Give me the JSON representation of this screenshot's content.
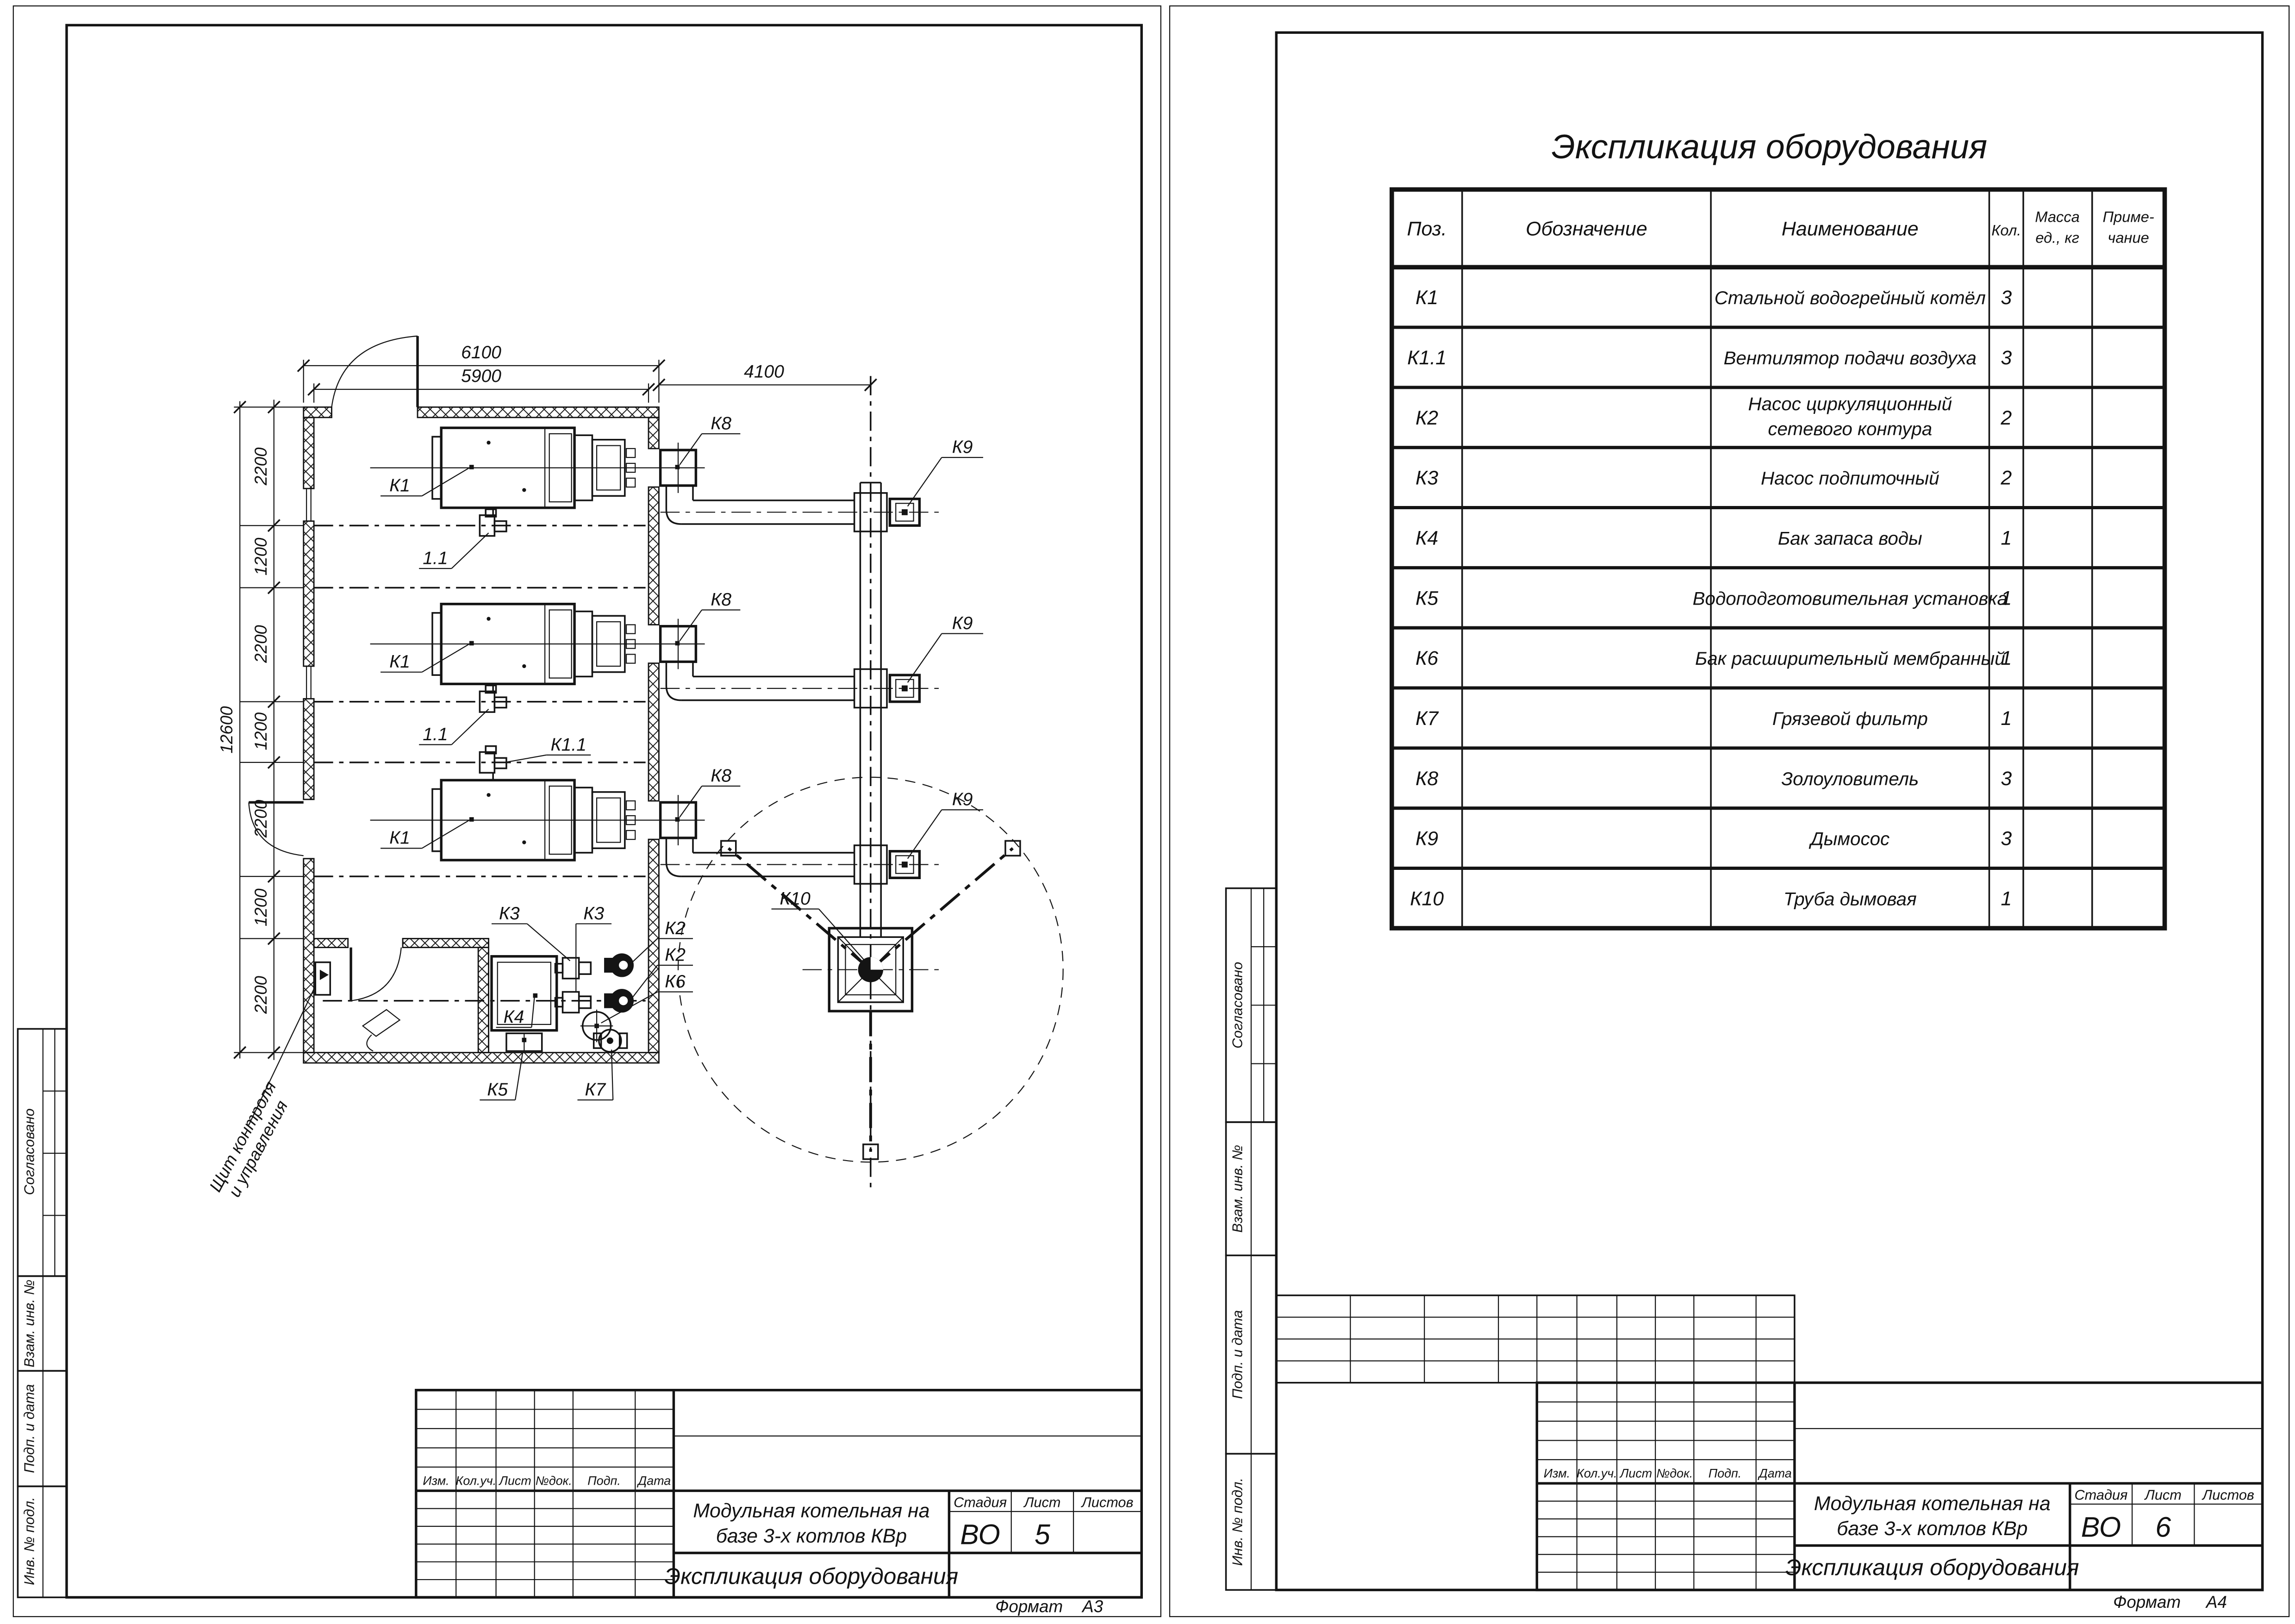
{
  "drawing": {
    "plan_dims": {
      "width_outer": "6100",
      "width_inner": "5900",
      "flue_offset": "4100",
      "height_total": "12600",
      "chain": [
        "2200",
        "1200",
        "2200",
        "1200",
        "2200",
        "1200",
        "2200"
      ]
    },
    "plan_labels": {
      "boiler": "К1",
      "boiler_fan": "1.1",
      "fan_unit": "К1.1",
      "ash_catcher": "К8",
      "smoke_exhauster": "К9",
      "chimney": "К10",
      "pump_network": "К2",
      "pump_feed": "К3",
      "water_tank": "К4",
      "water_treatment": "К5",
      "expansion_tank": "К6",
      "mud_filter": "К7",
      "control_panel_l1": "Щит контроля",
      "control_panel_l2": "и управления"
    }
  },
  "equip_table": {
    "title": "Экспликация оборудования",
    "headers": {
      "pos": "Поз.",
      "designation": "Обозначение",
      "name": "Наименование",
      "qty": "Кол.",
      "mass_l1": "Масса",
      "mass_l2": "ед., кг",
      "note_l1": "Приме-",
      "note_l2": "чание"
    },
    "rows": [
      {
        "pos": "К1",
        "name1": "Стальной водогрейный котёл",
        "name2": "",
        "qty": "3"
      },
      {
        "pos": "К1.1",
        "name1": "Вентилятор подачи воздуха",
        "name2": "",
        "qty": "3"
      },
      {
        "pos": "К2",
        "name1": "Насос циркуляционный",
        "name2": "сетевого контура",
        "qty": "2"
      },
      {
        "pos": "К3",
        "name1": "Насос подпиточный",
        "name2": "",
        "qty": "2"
      },
      {
        "pos": "К4",
        "name1": "Бак запаса воды",
        "name2": "",
        "qty": "1"
      },
      {
        "pos": "К5",
        "name1": "Водоподготовительная установка",
        "name2": "",
        "qty": "1"
      },
      {
        "pos": "К6",
        "name1": "Бак расширительный мембранный",
        "name2": "",
        "qty": "1"
      },
      {
        "pos": "К7",
        "name1": "Грязевой фильтр",
        "name2": "",
        "qty": "1"
      },
      {
        "pos": "К8",
        "name1": "Золоуловитель",
        "name2": "",
        "qty": "3"
      },
      {
        "pos": "К9",
        "name1": "Дымосос",
        "name2": "",
        "qty": "3"
      },
      {
        "pos": "К10",
        "name1": "Труба дымовая",
        "name2": "",
        "qty": "1"
      }
    ]
  },
  "title_block": {
    "cols": [
      "Изм.",
      "Кол.уч.",
      "Лист",
      "№док.",
      "Подп.",
      "Дата"
    ],
    "stage_label": "Стадия",
    "sheet_label": "Лист",
    "sheets_label": "Листов",
    "stage": "ВО",
    "project_l1": "Модульная котельная на",
    "project_l2": "базе 3-х котлов КВр",
    "doc_title": "Экспликация оборудования",
    "format_label": "Формат"
  },
  "sheet_left": {
    "sheet_number": "5",
    "format": "А3"
  },
  "sheet_right": {
    "sheet_number": "6",
    "format": "А4"
  },
  "side_stamp": {
    "agreed": "Согласовано",
    "replace_inv": "Взам. инв. №",
    "sign_date": "Подп. и дата",
    "inv_orig": "Инв. № подл."
  }
}
